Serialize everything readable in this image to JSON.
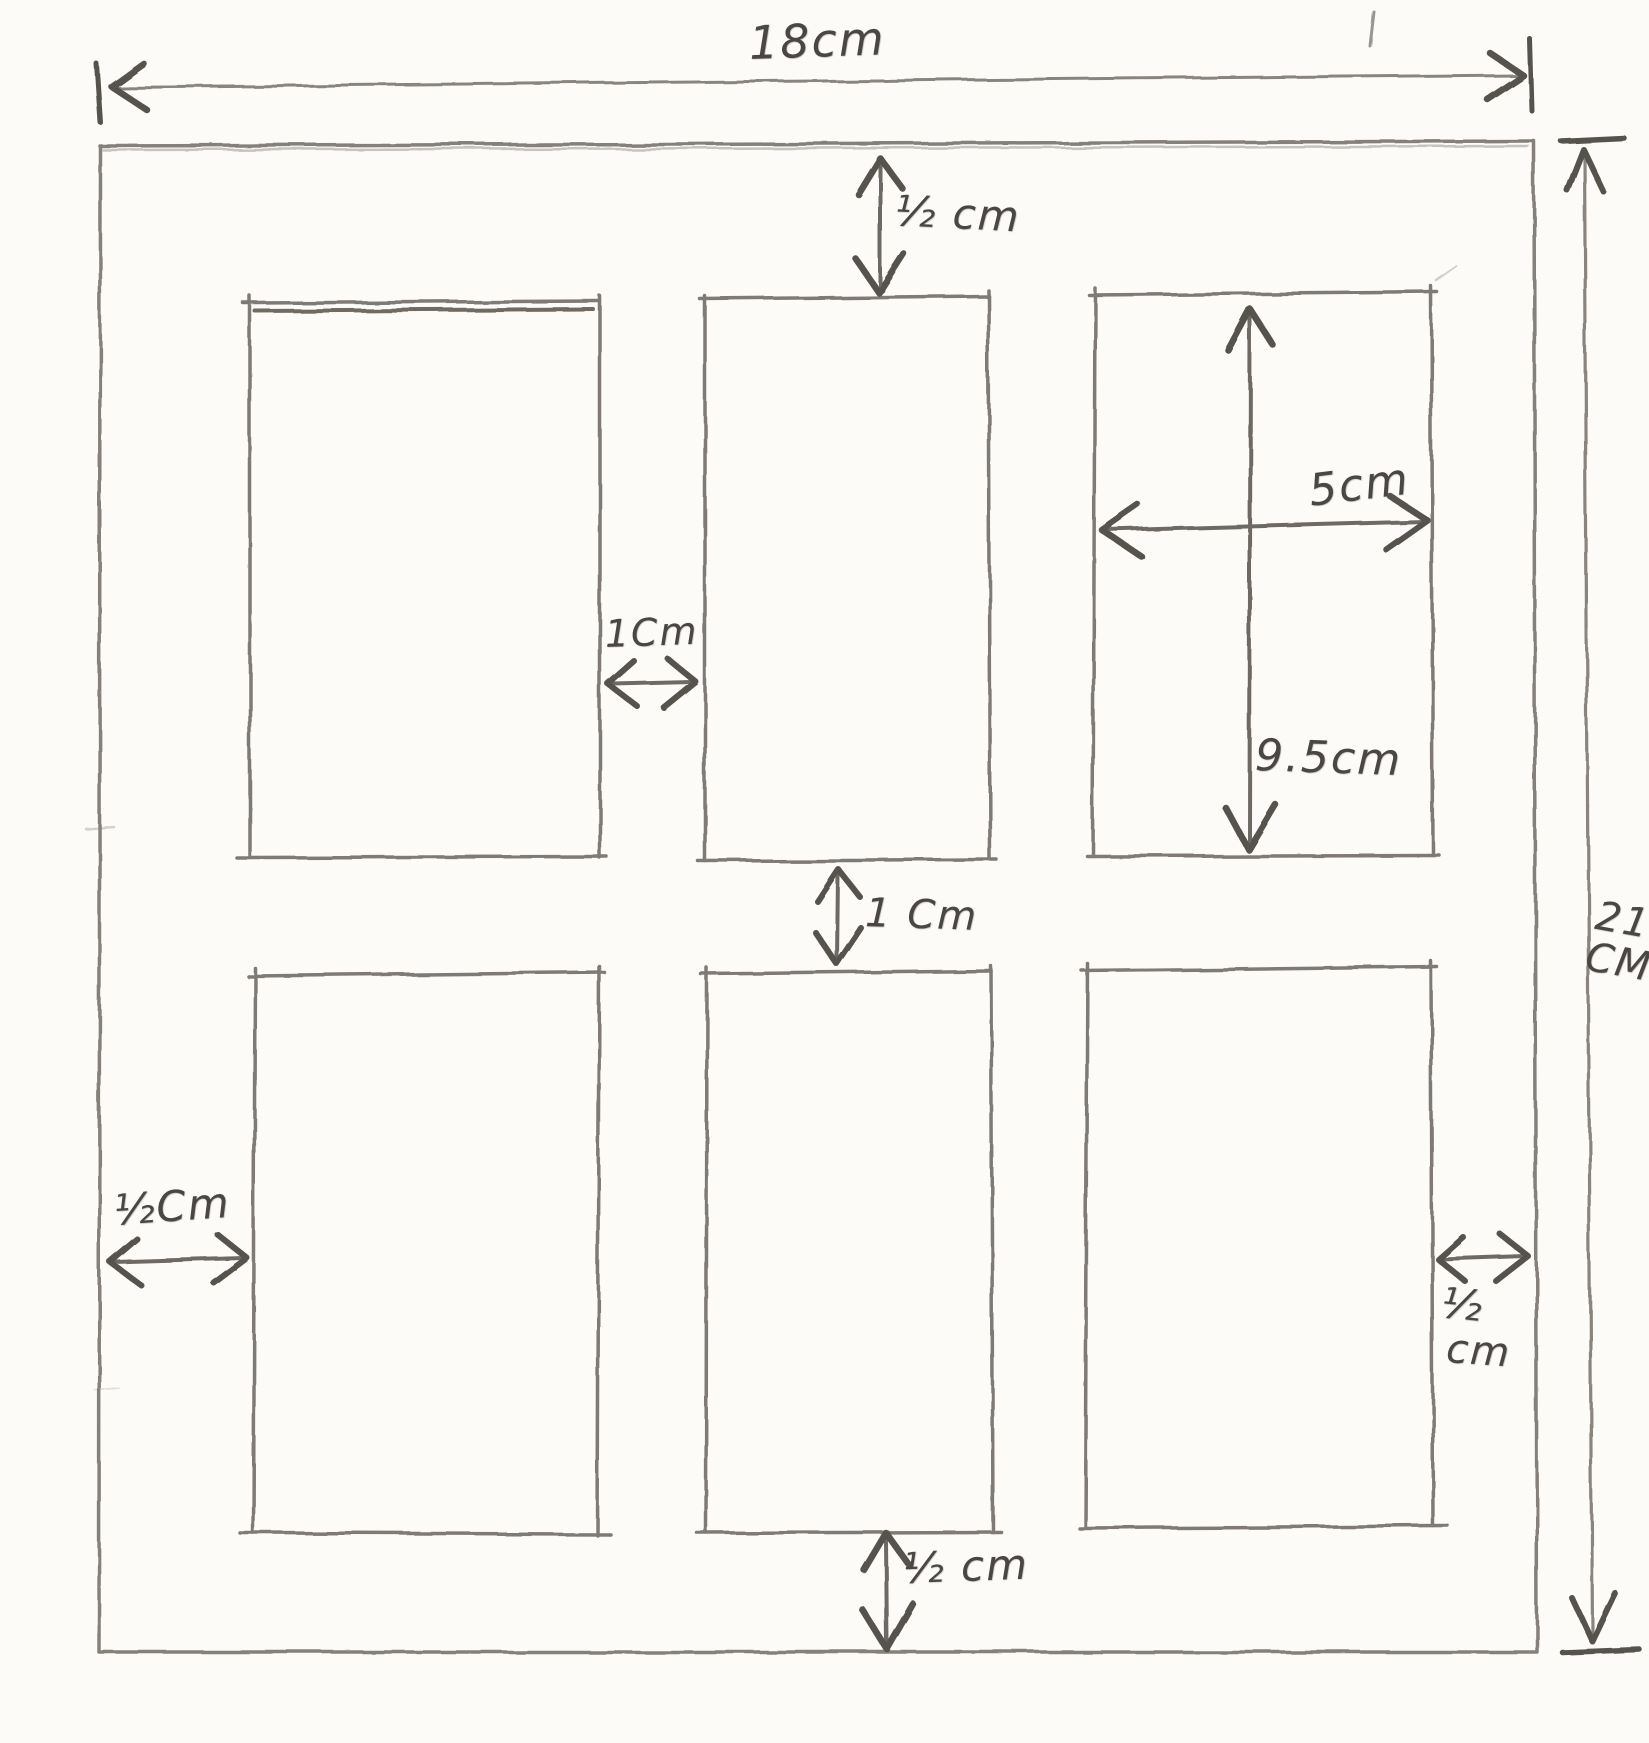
{
  "diagram": {
    "labels": {
      "top_width": "18cm",
      "top_margin": "½ cm",
      "cell_width": "5cm",
      "cell_height": "9.5cm",
      "column_gap": "1Cm",
      "row_gap": "1 Cm",
      "left_margin": "½Cm",
      "right_margin_fraction": "½",
      "right_margin_unit": "cm",
      "bottom_margin": "½ cm",
      "right_height_value": "21",
      "right_height_unit": "CM"
    },
    "colors": {
      "paper": "#fcfbf8",
      "pencil_line": "#85807a",
      "pencil_dark": "#57524e",
      "pencil_text": "#4a4643"
    }
  }
}
